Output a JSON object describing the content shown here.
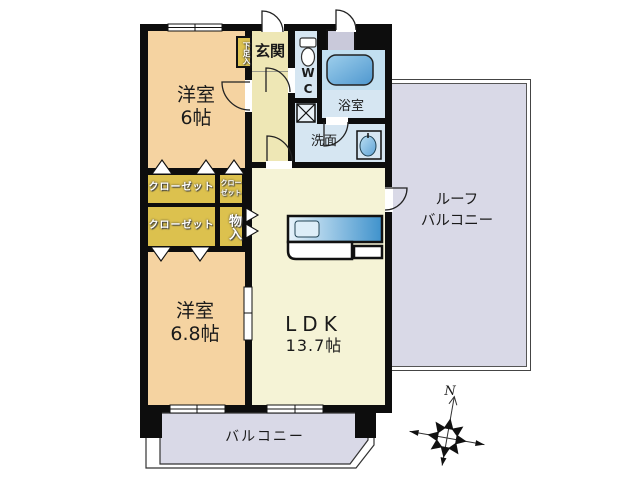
{
  "plan": {
    "room_west1": {
      "label": "洋室",
      "size": "6帖"
    },
    "room_west2": {
      "label": "洋室",
      "size": "6.8帖"
    },
    "ldk": {
      "label": "LDK",
      "size": "13.7帖"
    },
    "entrance": {
      "label": "玄関"
    },
    "wc": {
      "label": "WC"
    },
    "bath": {
      "label": "浴室"
    },
    "washroom": {
      "label": "洗面"
    },
    "closet_top": {
      "label": "クローゼット"
    },
    "closet_bottom": {
      "label": "クローゼット"
    },
    "closet_small": {
      "line1": "クロー",
      "line2": "ゼット"
    },
    "storage": {
      "label": "物入"
    },
    "shoe_box": {
      "label": "下足入"
    },
    "roof_balcony": {
      "line1": "ルーフ",
      "line2": "バルコニー"
    },
    "balcony": {
      "label": "バルコニー"
    },
    "compass": {
      "label": "N"
    }
  },
  "colors": {
    "wall": "#0d0d0d",
    "western_room": "#F5D3A1",
    "hallway": "#EEE7B5",
    "ldk": "#F5F3D6",
    "closet_gold": "#DCC14E",
    "wet_area_blue": "#D6E6F2",
    "bath_panel": "#C2DFF0",
    "balcony_lavender": "#D9D9E7",
    "utility_grey": "#C9C9DA"
  }
}
